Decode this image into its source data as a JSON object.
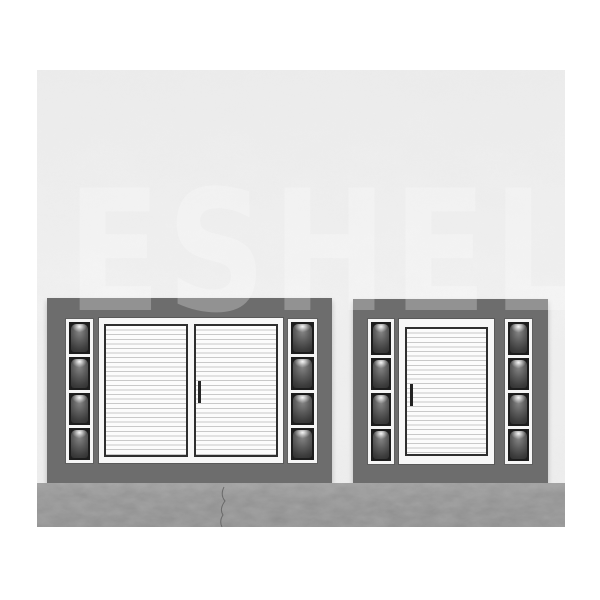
{
  "meta": {
    "type": "product-render-photo",
    "description": "Catalog render of two wall-mounted shutter-door display units on a plaster wall above a concrete floor, with a faint diagonal-free large watermark across the middle."
  },
  "watermark": {
    "text": "ESHEL",
    "opacity": 0.26,
    "color": "#ffffff"
  },
  "scene": {
    "wall": {
      "label": "white plaster wall",
      "color": "#efefef"
    },
    "floor": {
      "label": "gray concrete floor",
      "color": "#8f8f8f",
      "has_crack": true
    },
    "units": [
      {
        "id": "left-unit",
        "label": "double sliding louvered shutter unit",
        "panel_color": "#6d6d6d",
        "door_count": 2,
        "handle_count": 1,
        "light_columns": 2,
        "lights_per_column": 4,
        "shutter_color": "#fcfcfc",
        "slat_line_color": "#c9c9c9",
        "door_border_color": "#2f2f2f"
      },
      {
        "id": "right-unit",
        "label": "single louvered shutter unit",
        "panel_color": "#6d6d6d",
        "door_count": 1,
        "handle_count": 1,
        "light_columns": 2,
        "lights_per_column": 4,
        "shutter_color": "#fcfcfc",
        "slat_line_color": "#c9c9c9",
        "door_border_color": "#2f2f2f"
      }
    ],
    "lights_total": 16,
    "light_style": "recessed dark niche with small top-center downlight glow",
    "frame_color": "#f6f6f6"
  }
}
